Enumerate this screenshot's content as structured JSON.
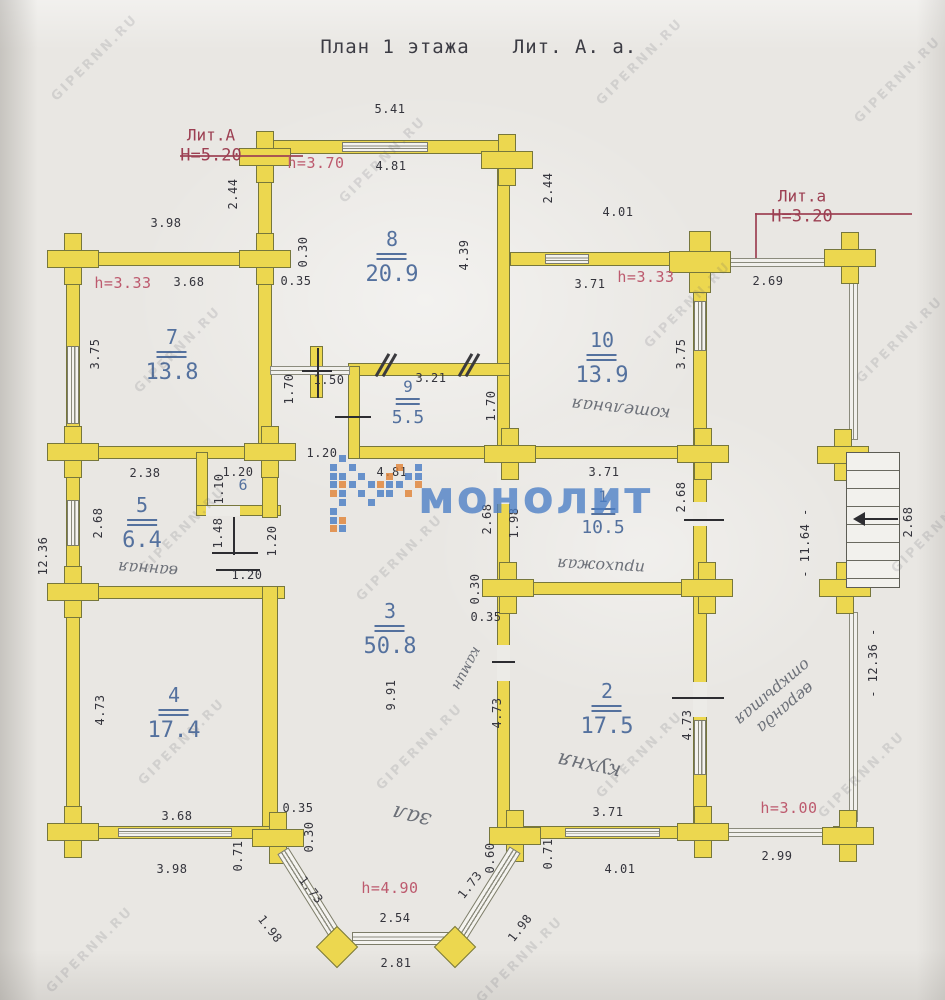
{
  "title": {
    "left": "План 1 этажа",
    "right": "Лит. А. а."
  },
  "watermark_text": "GIPERNN.RU",
  "logo_text": "монолит",
  "colors": {
    "wall": "#ecd74f",
    "wall_outline": "#77773c",
    "dim": "#34343c",
    "height": "#bd5a6e",
    "lit": "#9c3f52",
    "room": "#54719e",
    "hand": "#575c66",
    "logo_blue": "#4a7ec5",
    "logo_orange": "#e08438",
    "paper": "#e9e7e3"
  },
  "rooms": [
    {
      "num": "8",
      "area": "20.9",
      "x": 392,
      "y": 240,
      "size": "lg"
    },
    {
      "num": "7",
      "area": "13.8",
      "x": 172,
      "y": 338,
      "size": "lg"
    },
    {
      "num": "10",
      "area": "13.9",
      "x": 602,
      "y": 341,
      "size": "lg"
    },
    {
      "num": "9",
      "area": "5.5",
      "x": 408,
      "y": 390,
      "size": "sm"
    },
    {
      "num": "5",
      "area": "6.4",
      "x": 142,
      "y": 506,
      "size": "lg"
    },
    {
      "num": "6",
      "area": "",
      "x": 243,
      "y": 489,
      "size": "xs"
    },
    {
      "num": "1",
      "area": "10.5",
      "x": 603,
      "y": 500,
      "size": "sm"
    },
    {
      "num": "3",
      "area": "50.8",
      "x": 390,
      "y": 612,
      "size": "lg"
    },
    {
      "num": "4",
      "area": "17.4",
      "x": 174,
      "y": 696,
      "size": "lg"
    },
    {
      "num": "2",
      "area": "17.5",
      "x": 607,
      "y": 692,
      "size": "lg"
    }
  ],
  "heights": [
    {
      "t": "h=3.70",
      "x": 316,
      "y": 163
    },
    {
      "t": "h=3.33",
      "x": 123,
      "y": 283
    },
    {
      "t": "h=3.33",
      "x": 646,
      "y": 277
    },
    {
      "t": "h=4.90",
      "x": 390,
      "y": 888
    },
    {
      "t": "h=3.00",
      "x": 789,
      "y": 808
    }
  ],
  "lit_labels": [
    {
      "label": "Лит.А",
      "value": "H=5.20",
      "x": 211,
      "y": 146
    },
    {
      "label": "Лит.а",
      "value": "H=3.20",
      "x": 802,
      "y": 207
    }
  ],
  "hand_labels": [
    {
      "t": "котельная",
      "x": 621,
      "y": 408,
      "r": 186,
      "fs": 17
    },
    {
      "t": "ванная",
      "x": 148,
      "y": 569,
      "r": 184,
      "fs": 16
    },
    {
      "t": "прихожая",
      "x": 601,
      "y": 566,
      "r": 183,
      "fs": 16
    },
    {
      "t": "камин",
      "x": 466,
      "y": 668,
      "r": 118,
      "fs": 14
    },
    {
      "t": "зал",
      "x": 412,
      "y": 816,
      "r": 194,
      "fs": 22
    },
    {
      "t": "кухня",
      "x": 589,
      "y": 766,
      "r": 192,
      "fs": 21
    },
    {
      "t": "веранда\nоткрытая",
      "x": 779,
      "y": 700,
      "r": 140,
      "fs": 16
    }
  ],
  "dimensions": [
    {
      "t": "5.41",
      "x": 390,
      "y": 109
    },
    {
      "t": "4.81",
      "x": 391,
      "y": 166
    },
    {
      "t": "2.44",
      "x": 233,
      "y": 194,
      "r": -90
    },
    {
      "t": "3.98",
      "x": 166,
      "y": 223
    },
    {
      "t": "2.44",
      "x": 548,
      "y": 188,
      "r": -90
    },
    {
      "t": "4.01",
      "x": 618,
      "y": 212
    },
    {
      "t": "3.71",
      "x": 590,
      "y": 284
    },
    {
      "t": "2.69",
      "x": 768,
      "y": 281
    },
    {
      "t": "3.68",
      "x": 189,
      "y": 282
    },
    {
      "t": "0.30",
      "x": 303,
      "y": 252,
      "r": -90
    },
    {
      "t": "0.35",
      "x": 296,
      "y": 281
    },
    {
      "t": "4.39",
      "x": 464,
      "y": 255,
      "r": -90
    },
    {
      "t": "3.75",
      "x": 95,
      "y": 354,
      "r": -90
    },
    {
      "t": "3.75",
      "x": 681,
      "y": 354,
      "r": -90
    },
    {
      "t": "1.70",
      "x": 289,
      "y": 389,
      "r": -90
    },
    {
      "t": "1.50",
      "x": 329,
      "y": 380
    },
    {
      "t": "3.21",
      "x": 431,
      "y": 378
    },
    {
      "t": "1.70",
      "x": 491,
      "y": 406,
      "r": -90
    },
    {
      "t": "2.38",
      "x": 145,
      "y": 473
    },
    {
      "t": "1.20",
      "x": 238,
      "y": 472
    },
    {
      "t": "1.10",
      "x": 219,
      "y": 489,
      "r": -90
    },
    {
      "t": "1.20",
      "x": 322,
      "y": 453
    },
    {
      "t": "4.81",
      "x": 392,
      "y": 472
    },
    {
      "t": "3.71",
      "x": 604,
      "y": 472
    },
    {
      "t": "2.68",
      "x": 98,
      "y": 523,
      "r": -90
    },
    {
      "t": "12.36",
      "x": 43,
      "y": 556,
      "r": -90
    },
    {
      "t": "1.48",
      "x": 218,
      "y": 533,
      "r": -90
    },
    {
      "t": "1.20",
      "x": 272,
      "y": 541,
      "r": -90
    },
    {
      "t": "1.20",
      "x": 247,
      "y": 575
    },
    {
      "t": "2.68",
      "x": 487,
      "y": 519,
      "r": -90
    },
    {
      "t": "1.98",
      "x": 514,
      "y": 523,
      "r": -90
    },
    {
      "t": "2.68",
      "x": 681,
      "y": 497,
      "r": -90
    },
    {
      "t": "- 11.64 -",
      "x": 805,
      "y": 543,
      "r": -90
    },
    {
      "t": "2.68",
      "x": 908,
      "y": 522,
      "r": -90
    },
    {
      "t": "- 12.36 -",
      "x": 873,
      "y": 663,
      "r": -90
    },
    {
      "t": "0.30",
      "x": 475,
      "y": 589,
      "r": -90
    },
    {
      "t": "0.35",
      "x": 486,
      "y": 617
    },
    {
      "t": "9.91",
      "x": 391,
      "y": 695,
      "r": -90
    },
    {
      "t": "4.73",
      "x": 100,
      "y": 710,
      "r": -90
    },
    {
      "t": "4.73",
      "x": 497,
      "y": 713,
      "r": -90
    },
    {
      "t": "4.73",
      "x": 687,
      "y": 725,
      "r": -90
    },
    {
      "t": "3.68",
      "x": 177,
      "y": 816
    },
    {
      "t": "3.98",
      "x": 172,
      "y": 869
    },
    {
      "t": "0.35",
      "x": 298,
      "y": 808
    },
    {
      "t": "0.30",
      "x": 309,
      "y": 837,
      "r": -90
    },
    {
      "t": "0.71",
      "x": 238,
      "y": 856,
      "r": -90
    },
    {
      "t": "1.73",
      "x": 311,
      "y": 890,
      "r": 52
    },
    {
      "t": "1.98",
      "x": 270,
      "y": 929,
      "r": 52
    },
    {
      "t": "2.54",
      "x": 395,
      "y": 918
    },
    {
      "t": "2.81",
      "x": 396,
      "y": 963
    },
    {
      "t": "1.73",
      "x": 470,
      "y": 885,
      "r": -52
    },
    {
      "t": "1.98",
      "x": 520,
      "y": 928,
      "r": -52
    },
    {
      "t": "0.60",
      "x": 490,
      "y": 858,
      "r": -90
    },
    {
      "t": "0.71",
      "x": 548,
      "y": 854,
      "r": -90
    },
    {
      "t": "3.71",
      "x": 608,
      "y": 812
    },
    {
      "t": "4.01",
      "x": 620,
      "y": 869
    },
    {
      "t": "2.99",
      "x": 777,
      "y": 856
    }
  ]
}
